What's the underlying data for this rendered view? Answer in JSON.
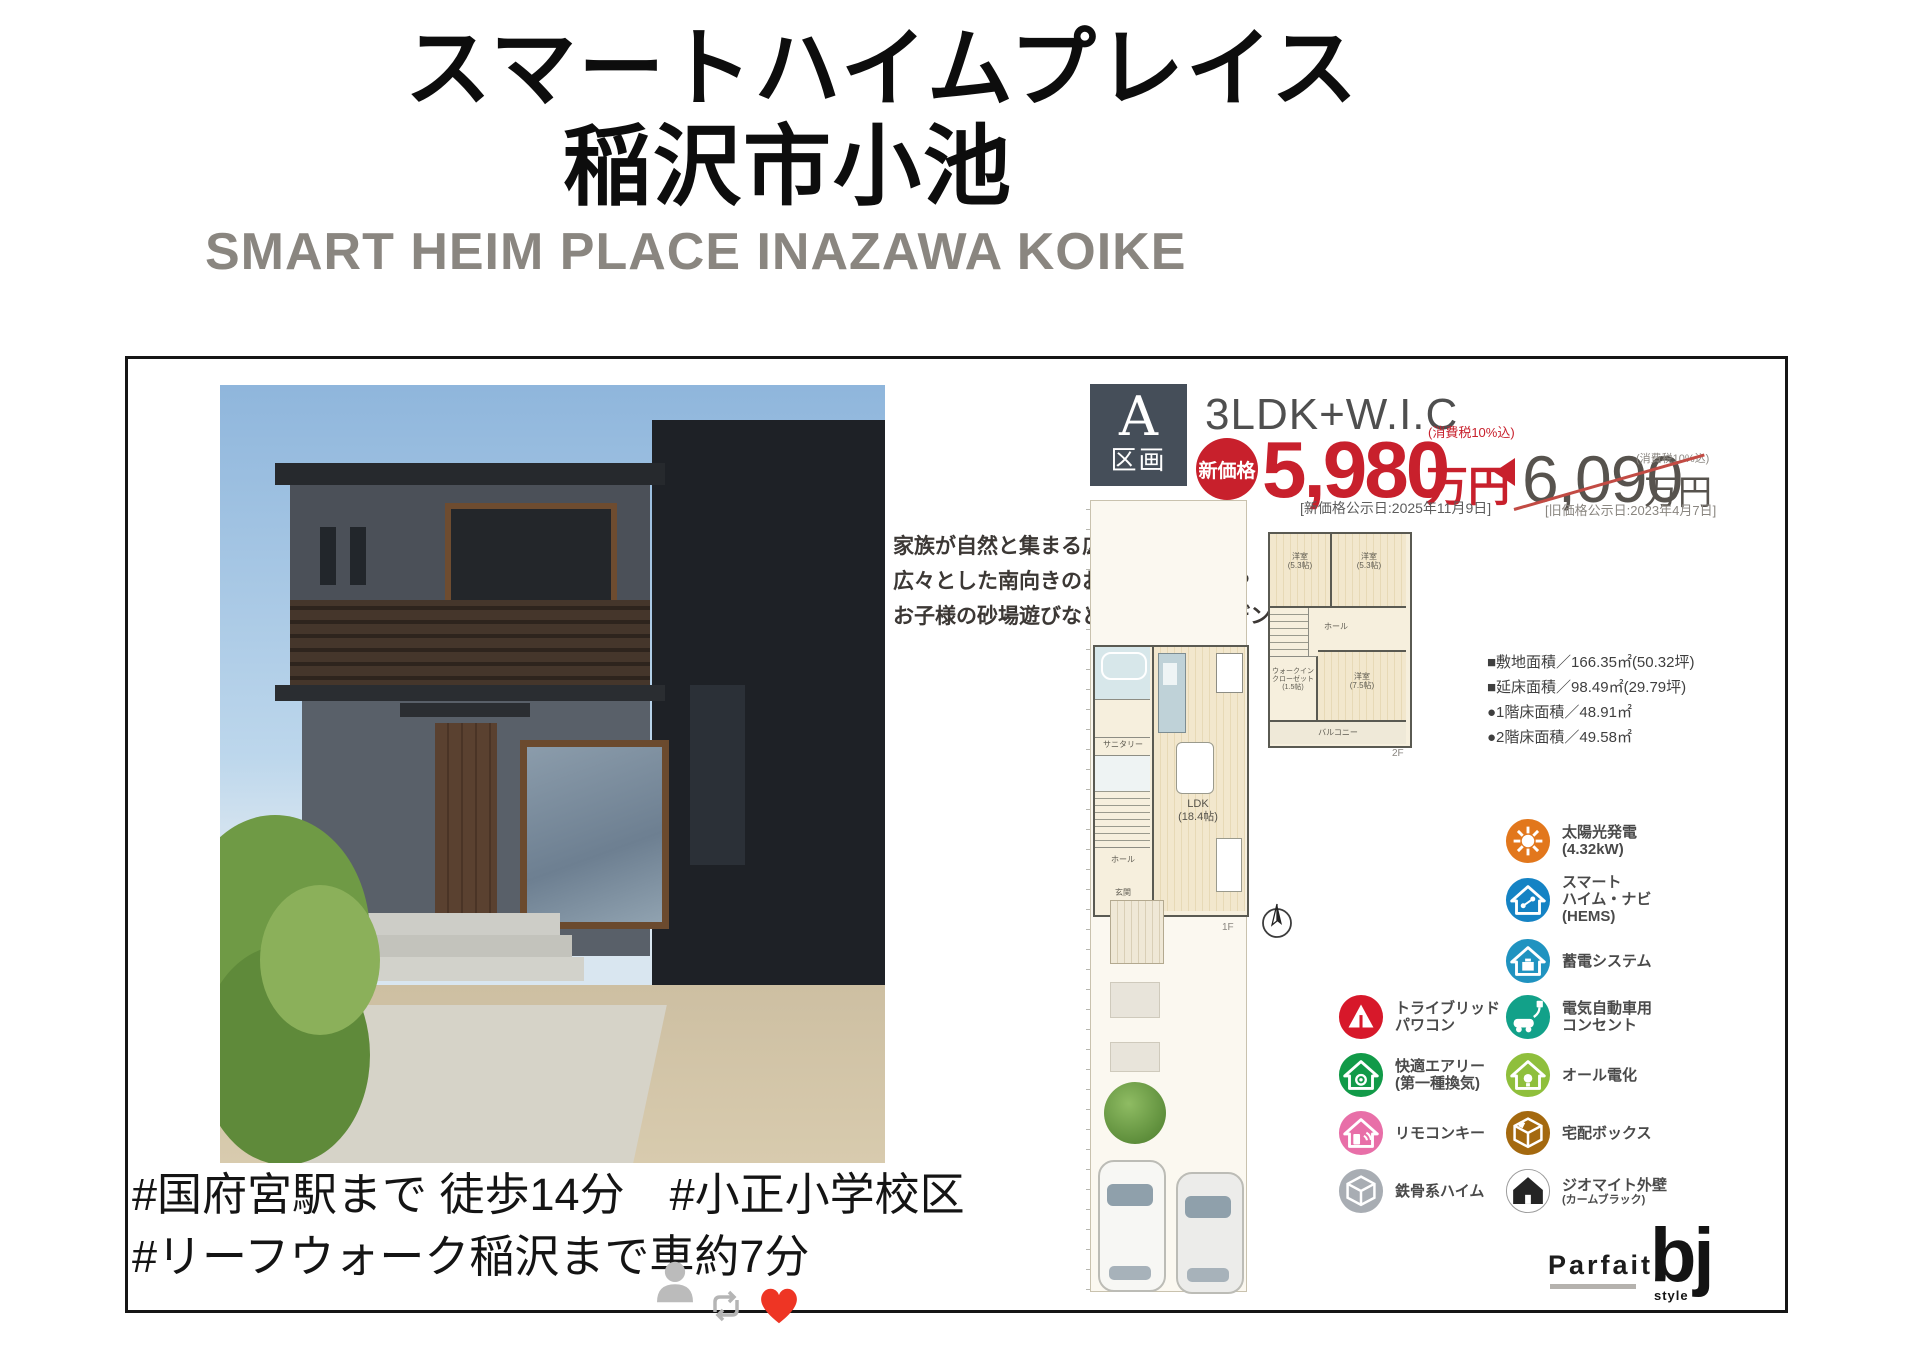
{
  "page": {
    "title_line1": "スマートハイムプレイス",
    "title_line2": "稲沢市小池",
    "subtitle": "SMART HEIM PLACE INAZAWA KOIKE"
  },
  "plot": {
    "block_letter": "A",
    "block_word": "区画",
    "layout": "3LDK+W.I.C",
    "new_price": {
      "badge": "新価格",
      "value": "5,980",
      "unit": "万円",
      "tax_note": "(消費税10%込)",
      "date_note": "[新価格公示日:2025年11月9日]"
    },
    "old_price": {
      "value": "6,090",
      "unit": "万円",
      "tax_note": "(消費税10%込)",
      "date_note": "[旧価格公示日:2023年4月7日]"
    }
  },
  "description": {
    "line1": "家族が自然と集まる広々LDK空間。",
    "line2": "広々とした南向きのお庭で家庭菜園や",
    "line3": "お子様の砂場遊びなどゆったりガーデンライフ。"
  },
  "areas": {
    "line1": "■敷地面積／166.35㎡(50.32坪)",
    "line2": "■延床面積／98.49㎡(29.79坪)",
    "line3": "●1階床面積／48.91㎡",
    "line4": "●2階床面積／49.58㎡"
  },
  "floorplan": {
    "ldk": "LDK\n(18.4帖)",
    "sanitary": "サニタリー",
    "entrance": "玄関",
    "hall1": "ホール",
    "floor1_tag": "1F",
    "room_a": "洋室\n(5.3帖)",
    "room_b": "洋室\n(5.3帖)",
    "room_c": "洋室\n(7.5帖)",
    "wic": "ウォークイン\nクローゼット\n(1.5帖)",
    "hall2": "ホール",
    "balcony": "バルコニー",
    "floor2_tag": "2F"
  },
  "features": {
    "solo": [
      {
        "label": "太陽光発電\n(4.32kW)",
        "color": "#e2771c"
      },
      {
        "label": "スマート\nハイム・ナビ\n(HEMS)",
        "color": "#1583c4"
      },
      {
        "label": "蓄電システム",
        "color": "#2093c0"
      }
    ],
    "left": [
      {
        "label": "トライブリッド\nパワコン",
        "color": "#d7182a"
      },
      {
        "label": "快適エアリー\n(第一種換気)",
        "color": "#119a48"
      },
      {
        "label": "リモコンキー",
        "color": "#e86fa8"
      },
      {
        "label": "鉄骨系ハイム",
        "color": "#a8adb3"
      }
    ],
    "right": [
      {
        "label": "電気自動車用\nコンセント",
        "color": "#12a189"
      },
      {
        "label": "オール電化",
        "color": "#8fbf3c"
      },
      {
        "label": "宅配ボックス",
        "color": "#a4690f"
      },
      {
        "label": "ジオマイト外壁",
        "sub": "(カームブラック)",
        "color": "#242424"
      }
    ]
  },
  "logo": {
    "brand": "Parfait",
    "mark": "bj",
    "style": "style"
  },
  "hashtags": {
    "line1": "#国府宮駅まで 徒歩14分　#小正小学校区",
    "line2": "#リーフウォーク稲沢まで車約7分"
  },
  "colors": {
    "price_red": "#c8202c",
    "heart": "#ee3524",
    "subtitle_gray": "#8a8680"
  }
}
